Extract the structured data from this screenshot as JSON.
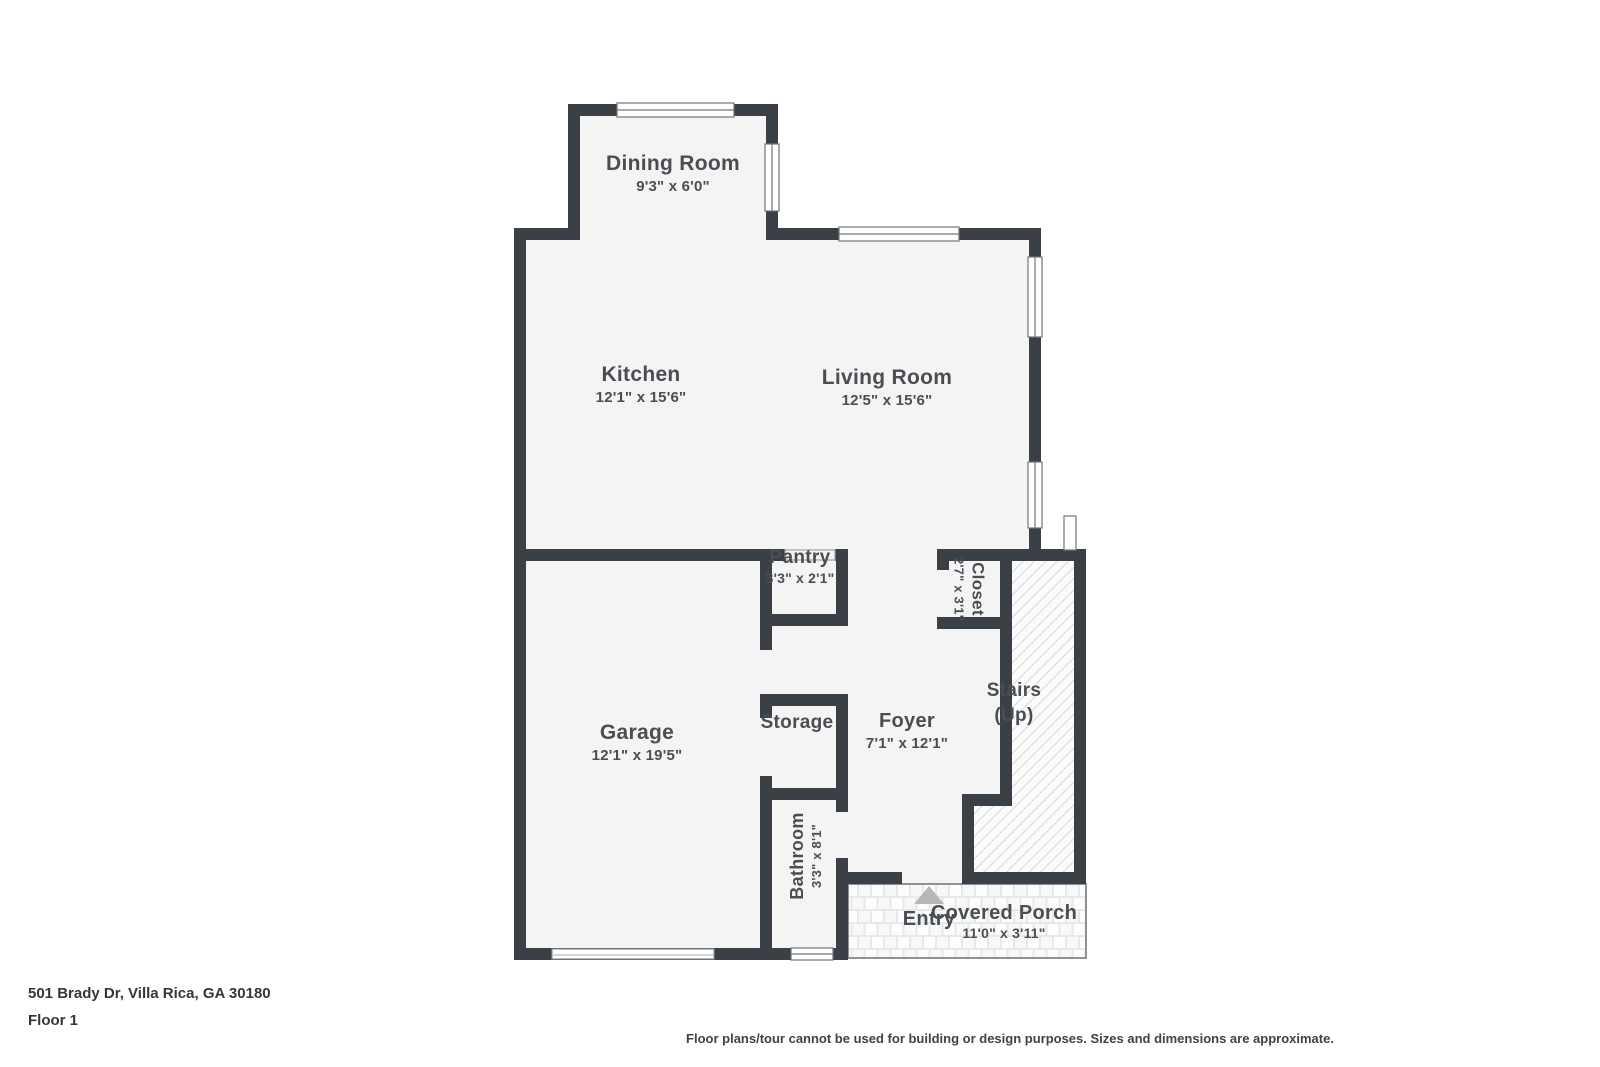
{
  "plan": {
    "rooms": {
      "dining_room": {
        "name": "Dining Room",
        "dims": "9'3\" x 6'0\""
      },
      "kitchen": {
        "name": "Kitchen",
        "dims": "12'1\" x 15'6\""
      },
      "living_room": {
        "name": "Living Room",
        "dims": "12'5\" x 15'6\""
      },
      "pantry": {
        "name": "Pantry",
        "dims": "3'3\" x 2'1\""
      },
      "closet": {
        "name": "Closet",
        "dims": "2'7\" x 3'1\""
      },
      "stairs": {
        "name": "Stairs",
        "sub": "(Up)"
      },
      "garage": {
        "name": "Garage",
        "dims": "12'1\" x 19'5\""
      },
      "storage": {
        "name": "Storage"
      },
      "foyer": {
        "name": "Foyer",
        "dims": "7'1\" x 12'1\""
      },
      "bathroom": {
        "name": "Bathroom",
        "dims": "3'3\" x 8'1\""
      },
      "entry": {
        "name": "Entry"
      },
      "covered_porch": {
        "name": "Covered Porch",
        "dims": "11'0\" x 3'11\""
      }
    }
  },
  "footer": {
    "address": "501 Brady Dr, Villa Rica, GA 30180",
    "floor": "Floor 1",
    "disclaimer": "Floor plans/tour cannot be used for building or design purposes. Sizes and dimensions are approximate."
  },
  "colors": {
    "wall": "#3b4046",
    "room": "#f4f4f5",
    "text": "#4a4e53",
    "hatch_line": "#c6c9cc",
    "hatch_bg": "#fbfbfb",
    "porch_bg": "#e7e8e9",
    "porch_tile": "#f7f8f8",
    "porch_border": "#8e9294",
    "window_stroke": "#70747a",
    "triangle": "#b5b7b9"
  }
}
